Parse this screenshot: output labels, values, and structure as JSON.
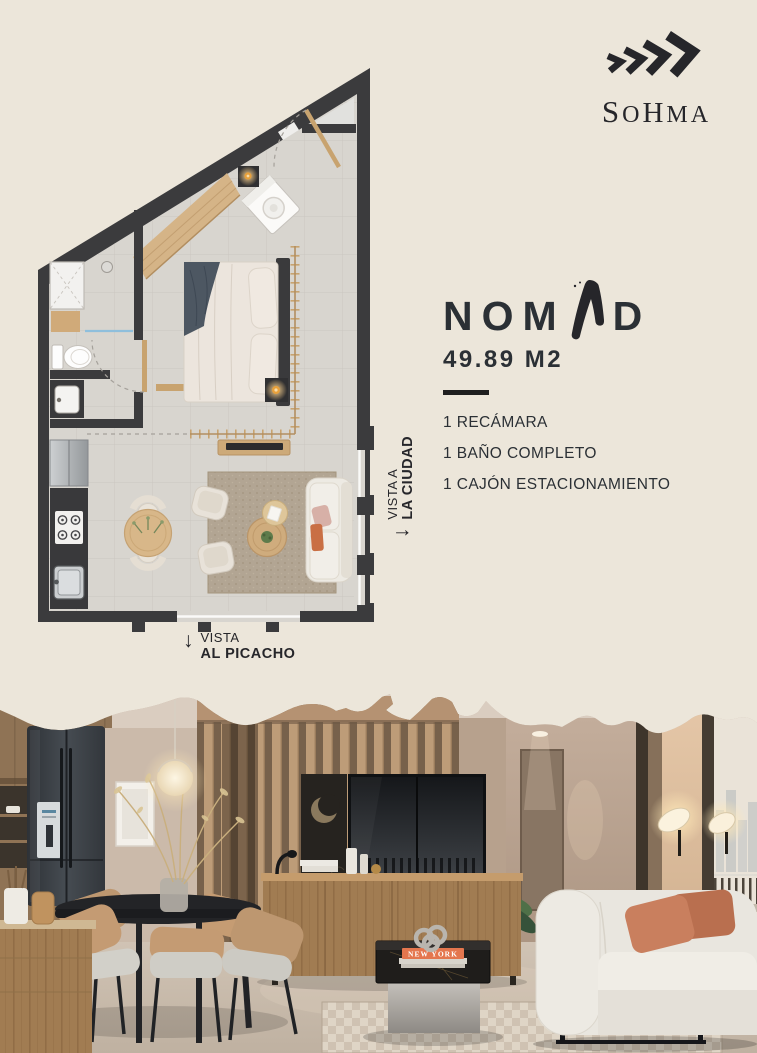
{
  "brand": {
    "name": "SOHMA",
    "letters": [
      "S",
      "O",
      "H",
      "M",
      "A"
    ]
  },
  "unit": {
    "name_prefix": "NOM",
    "name_stylized_letter": "A",
    "name_suffix": "D",
    "area": "49.89 M2",
    "features": [
      {
        "label": "1 RECÁMARA"
      },
      {
        "label": "1 BAÑO COMPLETO"
      },
      {
        "label": "1 CAJÓN ESTACIONAMIENTO"
      }
    ]
  },
  "floor_plan": {
    "view_labels": {
      "city": {
        "arrow": "↓",
        "line1": "VISTA A",
        "line2": "LA CIUDAD"
      },
      "picacho": {
        "arrow": "↓",
        "line1": "VISTA",
        "line2": "AL PICACHO"
      }
    }
  },
  "photo": {
    "book_title": "NEW YORK"
  },
  "colors": {
    "background": "#ECE6DA",
    "ink": "#26262A",
    "plan_wall": "#3B3B3D",
    "plan_floor": "#D8D5CF",
    "wood": "#C8A36F",
    "lamp_glow": "#E8A13C",
    "sofa_accent": "#C96F44"
  }
}
